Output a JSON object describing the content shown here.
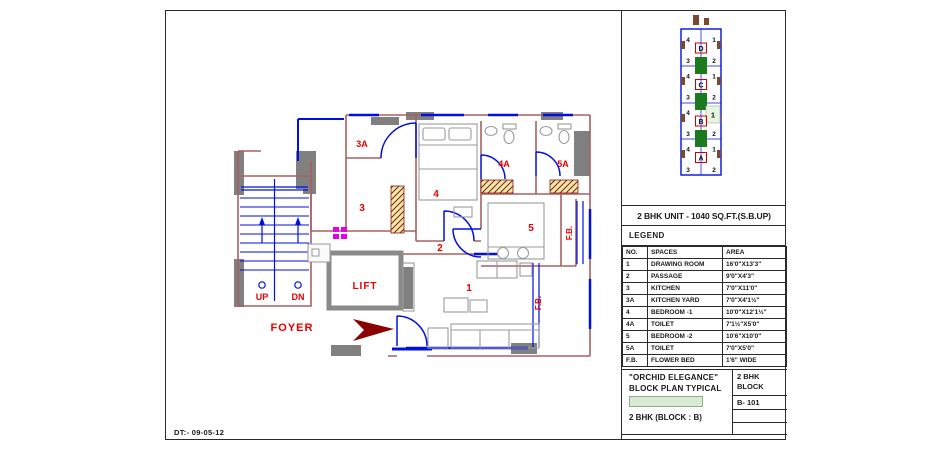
{
  "date": "DT:- 09-05-12",
  "unit_title": "2 BHK UNIT - 1040 SQ.FT.(S.B.UP)",
  "legend": {
    "title": "LEGEND",
    "headers": {
      "no": "NO.",
      "spaces": "SPACES",
      "area": "AREA"
    },
    "rows": [
      {
        "no": "1",
        "space": "DRAWING ROOM",
        "area": "16'0\"X13'3\""
      },
      {
        "no": "2",
        "space": "PASSAGE",
        "area": "9'0\"X4'3\""
      },
      {
        "no": "3",
        "space": "KITCHEN",
        "area": "7'0\"X11'0\""
      },
      {
        "no": "3A",
        "space": "KITCHEN YARD",
        "area": "7'0\"X4'1½\""
      },
      {
        "no": "4",
        "space": "BEDROOM -1",
        "area": "10'0\"X12'1½\""
      },
      {
        "no": "4A",
        "space": "TOILET",
        "area": "7'1½\"X5'0\""
      },
      {
        "no": "5",
        "space": "BEDROOM -2",
        "area": "10'6\"X10'0\""
      },
      {
        "no": "5A",
        "space": "TOILET",
        "area": "7'0\"X5'0\""
      },
      {
        "no": "F.B.",
        "space": "FLOWER BED",
        "area": "1'6\" WIDE"
      }
    ]
  },
  "title_block": {
    "project": "\"ORCHID ELEGANCE\"",
    "subtitle": "BLOCK PLAN TYPICAL",
    "unit_line": "2 BHK (BLOCK : B)",
    "block_label_1": "2 BHK",
    "block_label_2": "BLOCK",
    "unit_no": "B- 101"
  },
  "floor_plan": {
    "labels": {
      "lift": "LIFT",
      "foyer": "FOYER",
      "up": "UP",
      "dn": "DN",
      "fb": "F.B.",
      "r1": "1",
      "r2": "2",
      "r3": "3",
      "r3a": "3A",
      "r4": "4",
      "r4a": "4A",
      "r5": "5",
      "r5a": "5A"
    }
  },
  "block_plan": {
    "sections": [
      "D",
      "C",
      "B",
      "A"
    ],
    "unit_numbers": [
      "4",
      "1",
      "3",
      "2"
    ],
    "highlighted_unit": "1"
  },
  "colors": {
    "wall": "#a86060",
    "window_door": "#0010e0",
    "column_gray": "#808080",
    "label_red": "#e80000",
    "core_green": "#1c7a1c",
    "highlight_green": "#e4f6e0",
    "swatch_green": "#d9ead3",
    "fixture_magenta": "#e400e4",
    "hatch_yellow": "#efe9a8",
    "hatch_red": "#8b1a1a",
    "arrow_dark_red": "#8b0000"
  }
}
